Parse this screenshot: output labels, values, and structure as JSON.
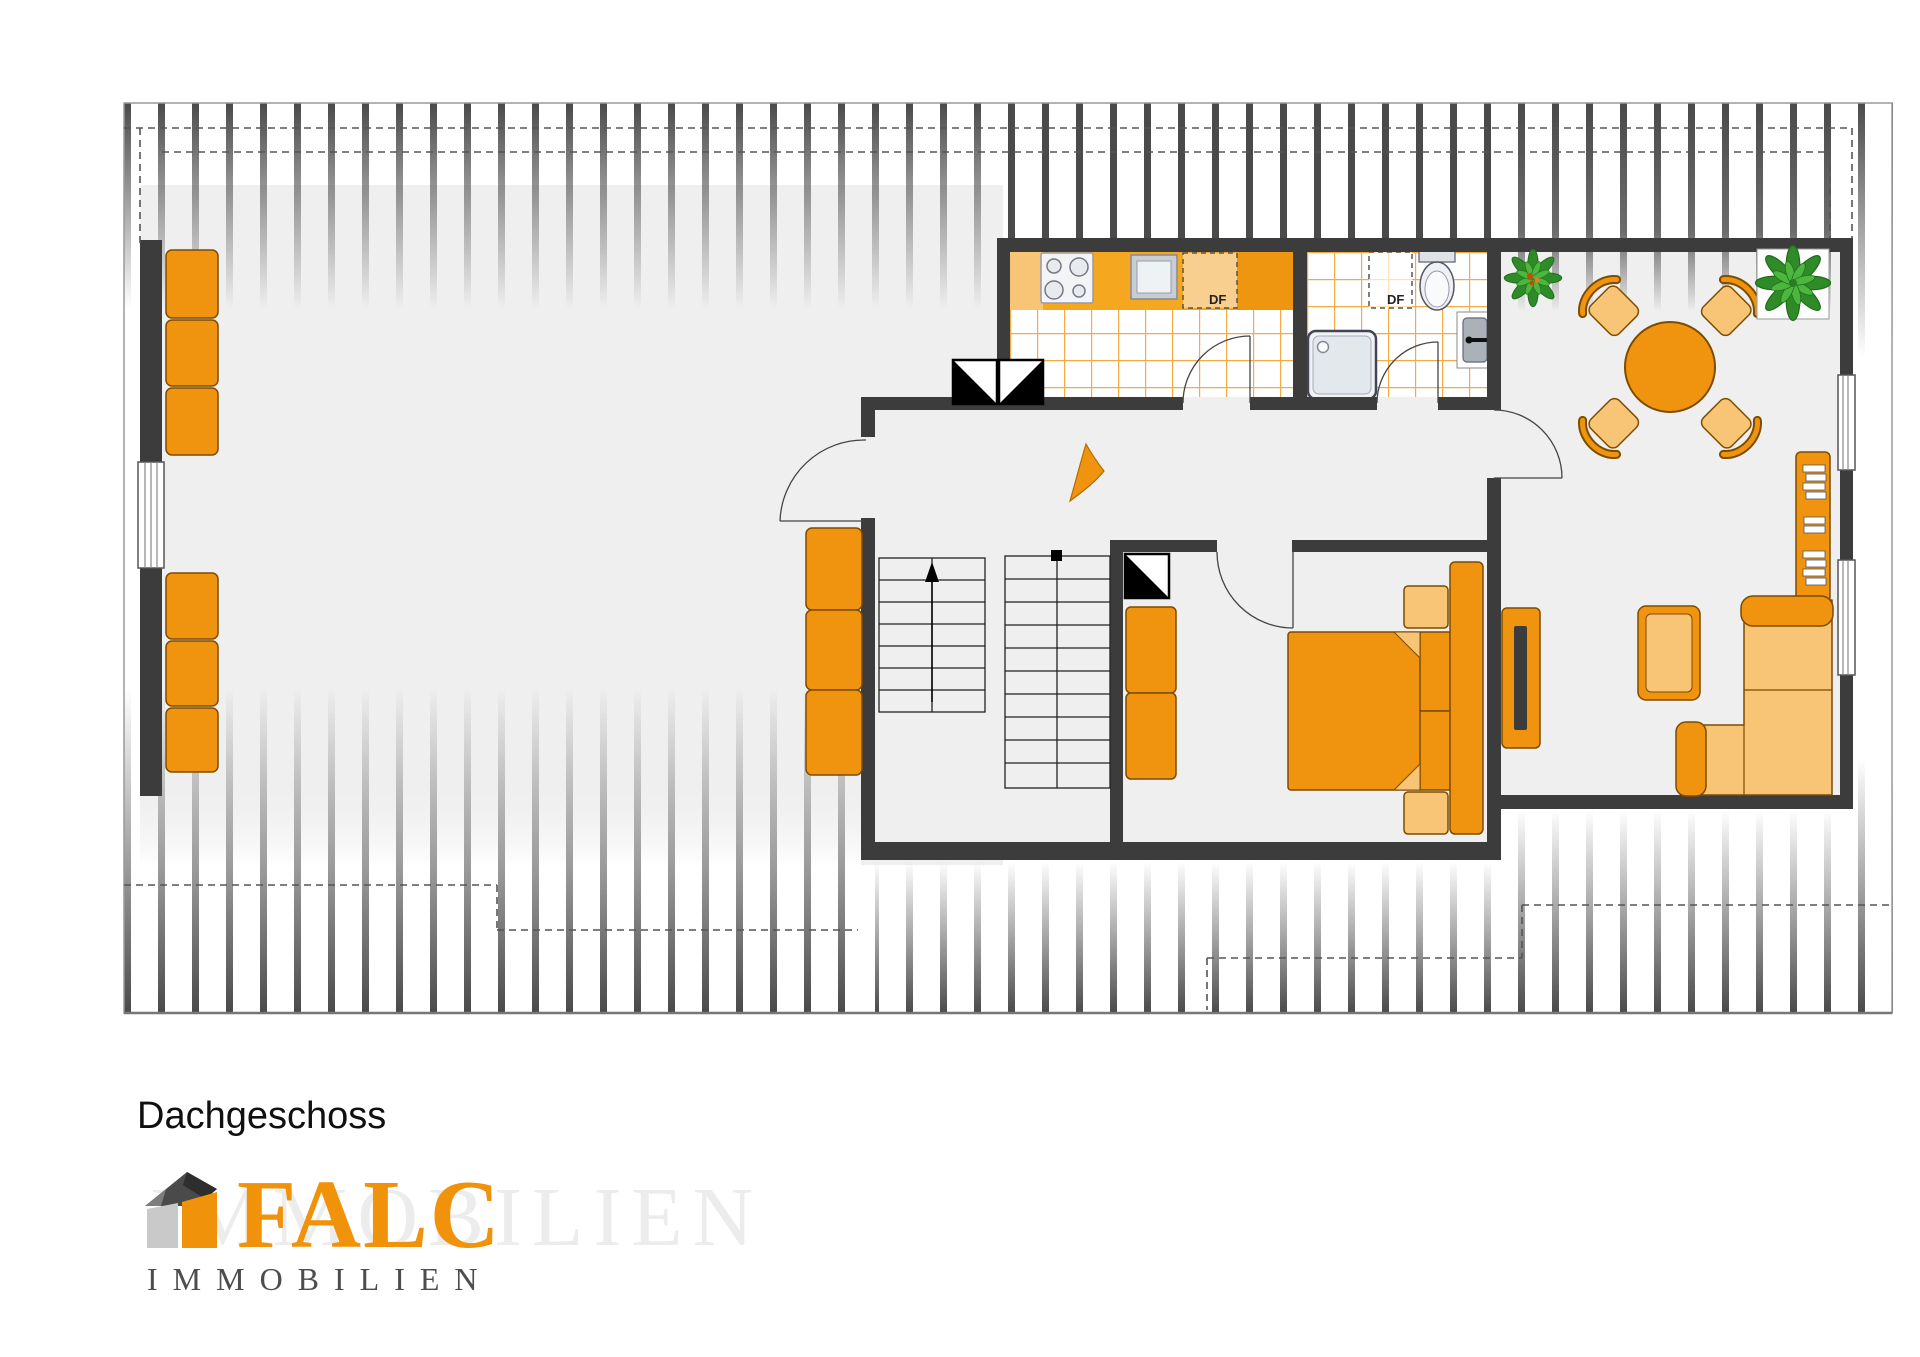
{
  "title": "Dachgeschoss",
  "logo": {
    "brand": "FALC",
    "subtitle": "IMMOBILIEN",
    "watermark": "IMMOBILIEN"
  },
  "plan": {
    "skylights": {
      "kitchen": "DF",
      "bath": "DF"
    },
    "rooms": {
      "kitchen": {
        "fixtures": [
          "counter",
          "stove",
          "sink",
          "roof-window"
        ]
      },
      "bathroom": {
        "fixtures": [
          "shower",
          "toilet",
          "washbasin",
          "roof-window"
        ]
      },
      "bedroom": {
        "fixtures": [
          "double-bed",
          "wardrobe",
          "nightstands",
          "chimney-shaft"
        ]
      },
      "living-dining": {
        "fixtures": [
          "round-table",
          "four-chairs",
          "corner-sofa",
          "coffee-table",
          "sideboard",
          "tv-board",
          "plants"
        ]
      },
      "hallway": {
        "fixtures": [
          "direction-arrow",
          "chimney-shafts"
        ]
      },
      "staircase": {
        "fixtures": [
          "stair-flight-up",
          "stair-flight-second"
        ]
      },
      "studio-left": {
        "fixtures": [
          "cabinet-row-upper",
          "cabinet-row-lower",
          "window"
        ]
      }
    }
  },
  "colors": {
    "wall": "#3c3c3c",
    "floor": "#efefef",
    "bar": "#4a4a4a",
    "furniture": "#f0940f",
    "furniture_light": "#f8c475",
    "counter": "#f5a81f",
    "tile": "#f3ac44",
    "plant_dark": "#2f8b27",
    "plant_light": "#4cb63e",
    "logo_orange": "#f0930b",
    "logo_gray": "#4d4d4d"
  }
}
